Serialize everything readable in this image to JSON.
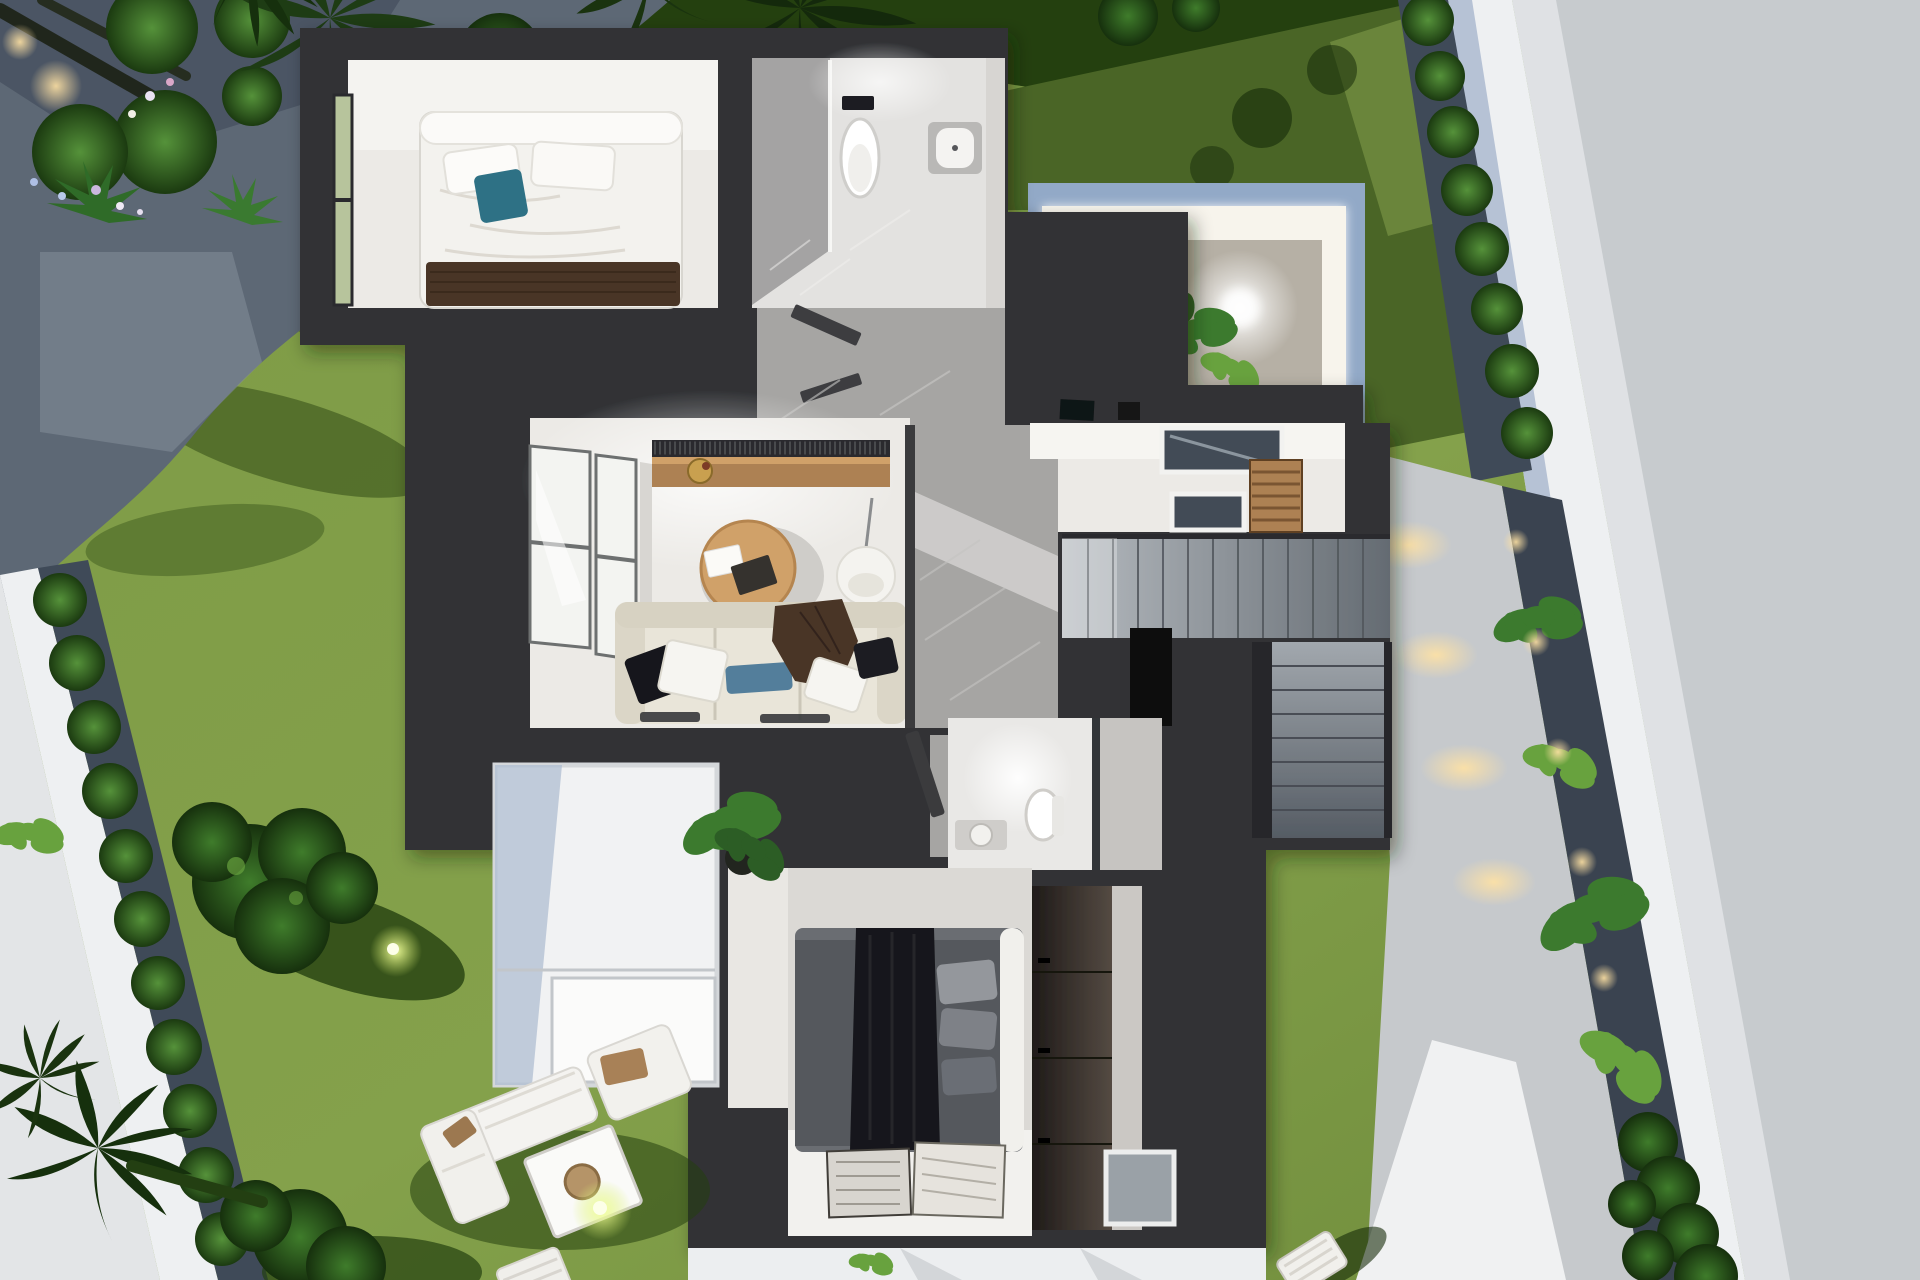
{
  "meta": {
    "title": "Top-down 3D architectural render of a modern villa floor plan with furnished rooms and landscaped garden"
  },
  "palette": {
    "house": "#313235",
    "houseDark": "#26272a",
    "houseLight": "#3b3d40",
    "floor": "#eceae6",
    "floorBright": "#f8f7f4",
    "marble": "#a6a5a3",
    "marbleLight": "#cfcecb",
    "lawn": "#7d9a45",
    "lawnLight": "#93ac57",
    "lawnShadow": "#4a6526",
    "lawnDark": "#24400f",
    "lawnDeep": "#152c09",
    "gravel": "#5d6875",
    "gravelLight": "#87919d",
    "gravelDark": "#3f4a58",
    "street": "#c7cbce",
    "streetLight": "#e3e5e7",
    "wall": "#eef0f2",
    "wallShade": "#afbdd1",
    "courtBlue": "#92a9c7",
    "courtGravel": "#b6b0a5",
    "wood": "#ad8152",
    "woodLight": "#d0a169",
    "sofa": "#e9e5d9",
    "sofaShade": "#d7d2c2",
    "teal": "#2f7185",
    "steelBlue": "#527e9b",
    "brown": "#4a3627",
    "white": "#f6f5f1",
    "stairA": "#b4b9be",
    "stairB": "#6a7077",
    "glass": "#f3f4f1",
    "frame": "#6d6f70",
    "winGreen": "#b7c49c",
    "bedGray": "#55585d",
    "bedDeep": "#17181b",
    "pillowGray": "#8f9297",
    "wardrobe": "#2b2421",
    "rugA": "#d8d5cf",
    "rugB": "#e6e3dd",
    "leaf": "#3c7a2e",
    "leafLight": "#68a23e",
    "bushEdge": "#1c3a12",
    "black": "#0c0d0f",
    "skylight": "#434c56",
    "pot": "#22251f"
  },
  "scene": {
    "labels": {
      "garden": "garden with lawn, gravel paths, palm trees and spotlights",
      "street": "surrounding street pavement",
      "boundaryWall": "white boundary wall with shrub border",
      "bedroom": "guest bedroom with double bed and teal cushion",
      "bathroom": "bathroom with walk-in shower, toilet and bidet",
      "livingRoom": "living room with sofa, round coffee table, hanging chair and TV sideboard",
      "hallway": "hallway with grey marble floor",
      "courtyard": "illuminated entrance courtyard with gravel bed and ferns",
      "vestibule": "entrance vestibule with skylights and timber slats",
      "staircase": "two-flight staircase",
      "guestBathroom": "guest WC with toilet and washbasin",
      "masterBedroom": "master bedroom with dark bedding, rugs and fitted wardrobe",
      "terrace": "white paved terrace with potted plant",
      "loungeSet": "outdoor lounge set with table and sun lounger",
      "walkway": "side walkway with accent lights and planting strip"
    }
  }
}
